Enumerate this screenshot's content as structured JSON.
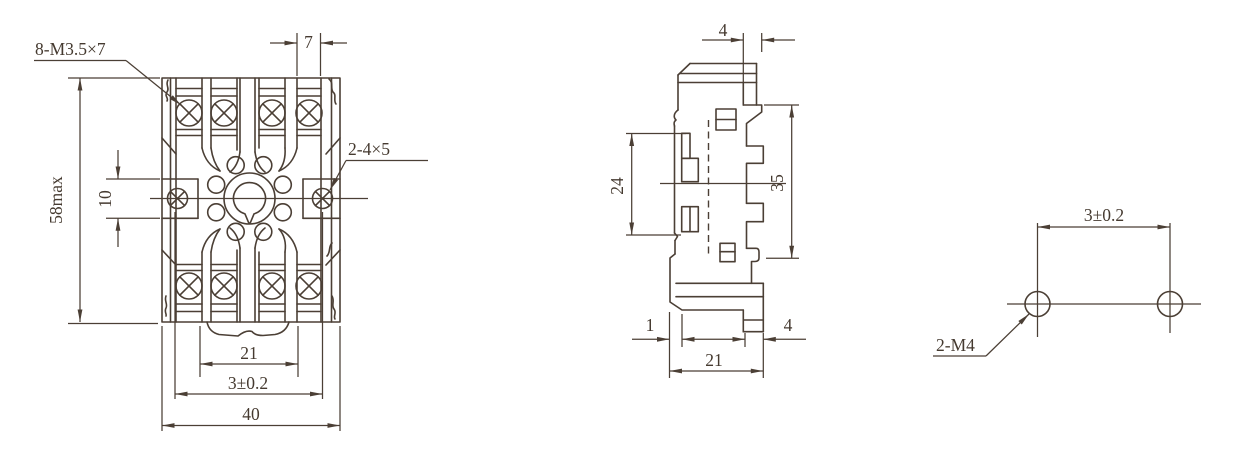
{
  "drawing": {
    "background": "#ffffff",
    "line_color": "#4b3f35",
    "text_color": "#453a30",
    "views": {
      "front": {
        "labels": {
          "thread_callout": "8-M3.5×7",
          "slot_width": "7",
          "side_hole_callout": "2-4×5",
          "overall_height": "58max",
          "side_hole_offset": "10",
          "tab_width": "21",
          "mount_spacing": "3±0.2",
          "overall_width": "40"
        }
      },
      "side": {
        "labels": {
          "rail_offset": "4",
          "clip_height": "24",
          "body_height": "35",
          "foot_offset": "1",
          "foot_width": "21",
          "foot_depth": "4"
        }
      },
      "mounting": {
        "labels": {
          "hole_spacing": "3±0.2",
          "hole_callout": "2-M4"
        }
      }
    }
  }
}
